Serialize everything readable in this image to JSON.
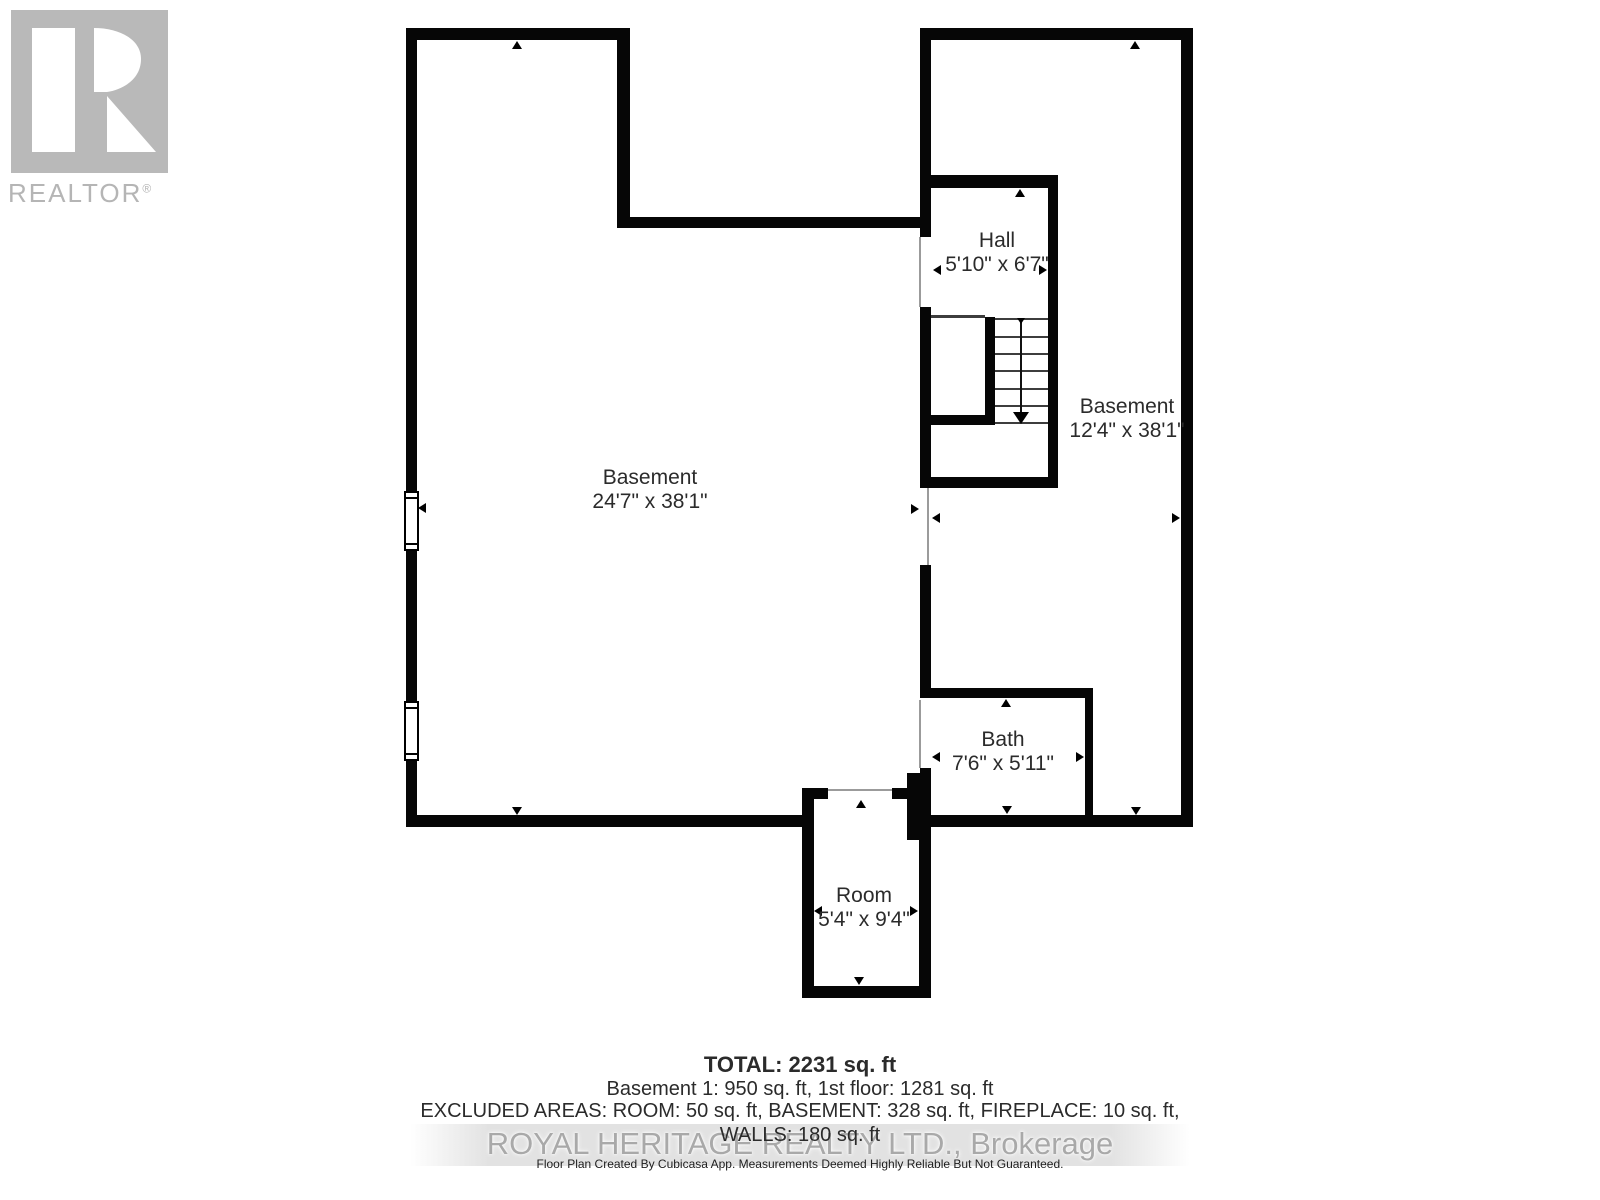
{
  "logo": {
    "letter": "R",
    "text": "REALTOR",
    "reg": "®"
  },
  "rooms": [
    {
      "id": "basement-left",
      "name": "Basement",
      "dims": "24'7\" x 38'1\""
    },
    {
      "id": "hall",
      "name": "Hall",
      "dims": "5'10\" x 6'7\""
    },
    {
      "id": "basement-right",
      "name": "Basement",
      "dims": "12'4\" x 38'1\""
    },
    {
      "id": "bath",
      "name": "Bath",
      "dims": "7'6\" x 5'11\""
    },
    {
      "id": "room",
      "name": "Room",
      "dims": "5'4\" x 9'4\""
    }
  ],
  "summary": {
    "total": "TOTAL: 2231 sq. ft",
    "floors": "Basement 1: 950 sq. ft, 1st floor: 1281 sq. ft",
    "excluded": "EXCLUDED AREAS: ROOM: 50 sq. ft, BASEMENT: 328 sq. ft, FIREPLACE: 10 sq. ft,",
    "walls": "WALLS: 180 sq. ft"
  },
  "watermark": "ROYAL HERITAGE REALTY LTD., Brokerage",
  "disclaimer": "Floor Plan Created By Cubicasa App. Measurements Deemed Highly Reliable But Not Guaranteed.",
  "colors": {
    "wall": "#060606",
    "text": "#2b2b2b",
    "logo_gray": "#b9b9b9",
    "watermark_gray": "#a9a9a9",
    "stair_line": "#3d3d3d"
  }
}
